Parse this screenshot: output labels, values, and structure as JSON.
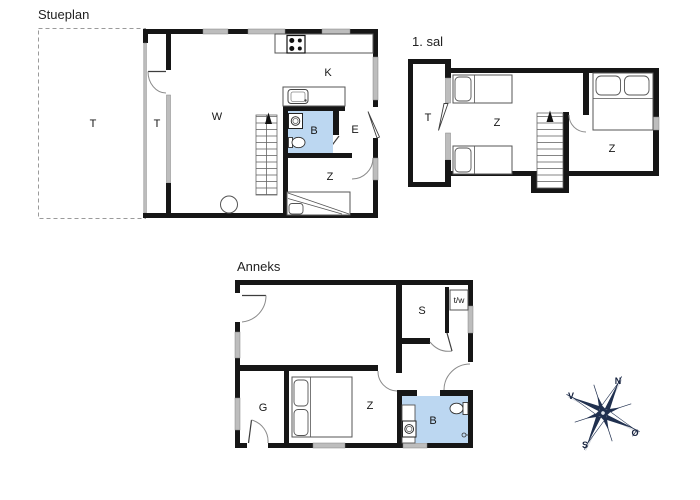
{
  "plans": {
    "stueplan": {
      "title": "Stueplan",
      "labels": {
        "terrace": "T",
        "hall": "T",
        "living": "W",
        "kitchen": "K",
        "bath": "B",
        "entry": "E",
        "bedroom": "Z"
      }
    },
    "first_floor": {
      "title": "1. sal",
      "labels": {
        "terrace": "T",
        "bedroom_left": "Z",
        "bedroom_right": "Z"
      }
    },
    "anneks": {
      "title": "Anneks",
      "labels": {
        "storage": "S",
        "toilet_wash": "t/w",
        "hall": "G",
        "bedroom": "Z",
        "bath": "B"
      }
    }
  },
  "compass": {
    "north": "N",
    "west": "V",
    "south": "S",
    "east": "Ø"
  },
  "colors": {
    "wall": "#161616",
    "window_gray": "#bdbdbd",
    "bath_blue": "#bcd7f1",
    "compass_navy": "#20304f"
  }
}
